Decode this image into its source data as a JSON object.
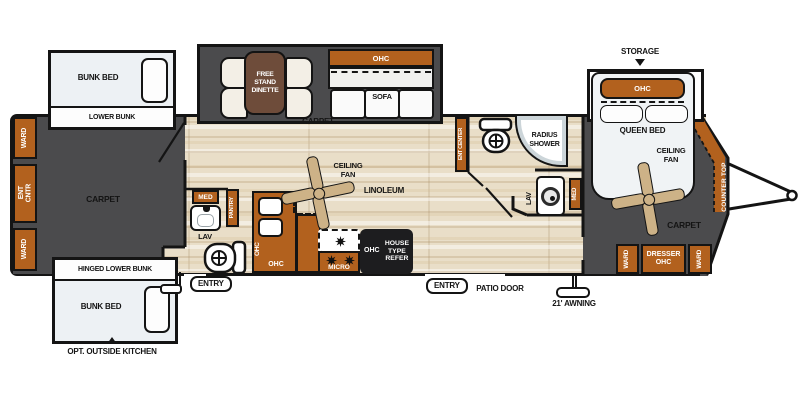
{
  "plan": {
    "exterior": {
      "storage": "STORAGE",
      "awning": "21' AWNING",
      "patio_door": "PATIO DOOR",
      "entry_rear": "ENTRY",
      "entry_main": "ENTRY",
      "outside_kitchen": "OPT. OUTSIDE KITCHEN"
    },
    "lounge": {
      "floor": "CARPET",
      "ward_top": "WARD",
      "ent_cntr": "ENT\nCNTR",
      "ward_bottom": "WARD",
      "upper_bunk_slide": {
        "bed": "BUNK BED",
        "band": "LOWER BUNK"
      },
      "lower_bunk_slide": {
        "band": "HINGED LOWER BUNK",
        "bed": "BUNK BED"
      }
    },
    "dinette_slide": {
      "floor": "CARPET",
      "dinette": "FREE\nSTAND\nDINETTE",
      "ohc": "OHC",
      "sofa": "SOFA"
    },
    "kitchen": {
      "floor": "LINOLEUM",
      "ceiling_fan": "CEILING\nFAN",
      "med": "MED",
      "lav": "LAV",
      "pantry": "PANTRY",
      "ohc_side": "OHC",
      "ohc_front": "OHC",
      "micro": "MICRO",
      "refer_ohc": "OHC",
      "refer": "HOUSE\nTYPE\nREFER"
    },
    "mid_bath": {
      "ent_center": "ENT CENTER",
      "radius_shower": "RADIUS\nSHOWER",
      "lav": "LAV",
      "med": "MED"
    },
    "bedroom": {
      "floor": "CARPET",
      "queen_ohc": "OHC",
      "queen_bed": "QUEEN BED",
      "ceiling_fan": "CEILING\nFAN",
      "ward_left": "WARD",
      "dresser": "DRESSER\nOHC",
      "ward_right": "WARD",
      "counter_top": "COUNTER TOP"
    },
    "colors": {
      "cabinet": "#b2611e",
      "carpet": "#4b4b4d",
      "linoleum": "#e9dec8"
    }
  }
}
